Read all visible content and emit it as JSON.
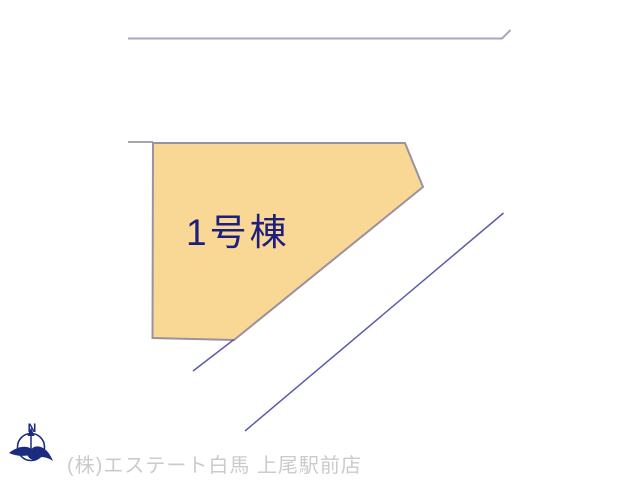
{
  "plot": {
    "label": "1号棟",
    "fill_color": "#f9d795",
    "border_color": "#9a92a0",
    "label_color": "#1e1e7d"
  },
  "compass": {
    "north_label": "N",
    "color": "#1b2b80"
  },
  "footer": {
    "company": "(株)エステート白馬 上尾駅前店",
    "text_color": "#cbcbcb"
  },
  "lines": {
    "north_boundary_color": "#a6a6c2",
    "west_boundary_color": "#a9a3ab",
    "road_color": "#5c5cab"
  },
  "background_color": "#ffffff"
}
